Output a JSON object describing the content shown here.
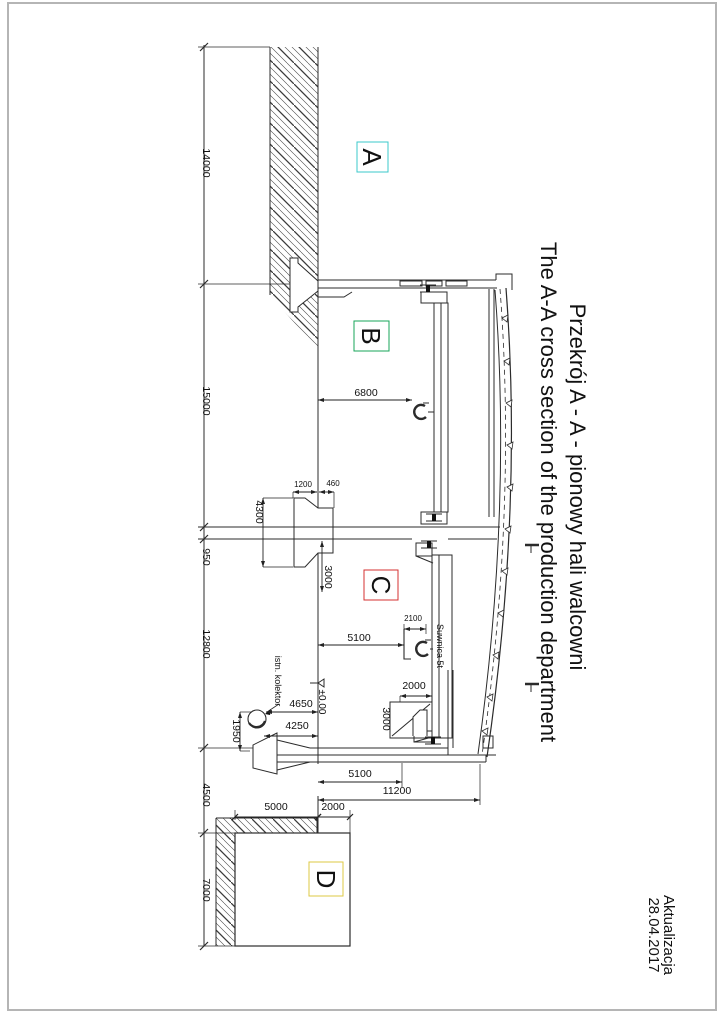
{
  "page": {
    "background": "#ffffff",
    "border_color": "#b5b5b5"
  },
  "title": {
    "polish": "Przekrój A - A - pionowy hali walcowni",
    "english": "The A-A cross section of the production department"
  },
  "revision": {
    "label": "Aktualizacja",
    "date": "28.04.2017"
  },
  "zones": [
    {
      "id": "A",
      "color": "#3bc8cb",
      "box": [
        357,
        142,
        31,
        30
      ],
      "text_pos": [
        363,
        157
      ]
    },
    {
      "id": "B",
      "color": "#17a55a",
      "box": [
        354,
        321,
        35,
        30
      ],
      "text_pos": [
        362,
        336
      ]
    },
    {
      "id": "C",
      "color": "#d43131",
      "box": [
        364,
        570,
        34,
        30
      ],
      "text_pos": [
        372,
        585
      ]
    },
    {
      "id": "D",
      "color": "#ddc843",
      "box": [
        309,
        862,
        34,
        34
      ],
      "text_pos": [
        317,
        879
      ]
    }
  ],
  "labels": [
    {
      "name": "crane-label",
      "text": "Suwnica 5t",
      "pos": [
        437,
        646
      ],
      "rot": true,
      "size": 9
    },
    {
      "name": "collector-label",
      "text": "istn. kolektor",
      "pos": [
        275,
        681
      ],
      "rot": true,
      "size": 9
    },
    {
      "name": "level-label",
      "text": "±0.00",
      "pos": [
        319,
        702
      ],
      "rot": true,
      "size": 10
    }
  ],
  "dimensions": [
    {
      "value": "14000",
      "text_pos": [
        203,
        163
      ],
      "rot": true
    },
    {
      "value": "15000",
      "text_pos": [
        203,
        401
      ],
      "rot": true
    },
    {
      "value": "950",
      "text_pos": [
        203,
        557
      ],
      "rot": true
    },
    {
      "value": "12800",
      "text_pos": [
        203,
        644
      ],
      "rot": true
    },
    {
      "value": "4500",
      "text_pos": [
        203,
        795
      ],
      "rot": true
    },
    {
      "value": "7000",
      "text_pos": [
        203,
        890
      ],
      "rot": true
    },
    {
      "value": "6800",
      "text_pos": [
        366,
        396
      ],
      "line": [
        318,
        400,
        412,
        400
      ],
      "style": "arrow"
    },
    {
      "value": "1200",
      "text_pos": [
        303,
        487
      ],
      "size": 8,
      "line": [
        293,
        492,
        317,
        492
      ],
      "style": "arrow",
      "ext": [
        [
          293,
          492,
          293,
          498
        ]
      ]
    },
    {
      "value": "460",
      "text_pos": [
        333,
        486
      ],
      "size": 8,
      "line": [
        319,
        492,
        334,
        492
      ],
      "style": "arrow",
      "ext": [
        [
          334,
          492,
          334,
          508
        ]
      ]
    },
    {
      "value": "4300",
      "text_pos": [
        256,
        512
      ],
      "rot": true,
      "line": [
        263,
        498,
        263,
        567
      ],
      "style": "arrow",
      "ext": [
        [
          263,
          498,
          293,
          498
        ],
        [
          263,
          567,
          293,
          567
        ]
      ]
    },
    {
      "value": "3000",
      "text_pos": [
        325,
        577
      ],
      "rot": true,
      "line": [
        322,
        541,
        322,
        592
      ],
      "style": "arrow"
    },
    {
      "value": "2100",
      "text_pos": [
        413,
        621
      ],
      "size": 8,
      "line": [
        404,
        629,
        426,
        629
      ],
      "style": "arrow",
      "ext": [
        [
          404,
          624,
          404,
          634
        ],
        [
          426,
          624,
          426,
          634
        ]
      ]
    },
    {
      "value": "5100",
      "text_pos": [
        359,
        641
      ],
      "line": [
        318,
        645,
        404,
        645
      ],
      "style": "arrow"
    },
    {
      "value": "2000",
      "text_pos": [
        414,
        689
      ],
      "line": [
        400,
        696,
        432,
        696
      ],
      "style": "arrow",
      "ext": [
        [
          400,
          696,
          400,
          702
        ],
        [
          432,
          696,
          432,
          702
        ]
      ]
    },
    {
      "value": "3000",
      "text_pos": [
        383,
        719
      ],
      "rot": true
    },
    {
      "value": "4650",
      "text_pos": [
        301,
        707
      ],
      "line": [
        266,
        712,
        318,
        712
      ],
      "style": "arrow"
    },
    {
      "value": "4250",
      "text_pos": [
        297,
        729
      ],
      "line": [
        264,
        736,
        318,
        736
      ],
      "style": "arrow"
    },
    {
      "value": "1950",
      "text_pos": [
        233,
        731
      ],
      "rot": true,
      "line": [
        240,
        712,
        240,
        751
      ],
      "style": "arrow",
      "ext": [
        [
          240,
          712,
          252,
          712
        ],
        [
          240,
          751,
          250,
          751
        ]
      ]
    },
    {
      "value": "5100",
      "text_pos": [
        360,
        777
      ],
      "line": [
        318,
        782,
        402,
        782
      ],
      "style": "arrow",
      "ext": [
        [
          402,
          763,
          402,
          787
        ]
      ]
    },
    {
      "value": "11200",
      "text_pos": [
        397,
        794
      ],
      "line": [
        318,
        800,
        480,
        800
      ],
      "style": "arrow",
      "ext": [
        [
          480,
          764,
          480,
          805
        ]
      ]
    },
    {
      "value": "5000",
      "text_pos": [
        276,
        810
      ],
      "line": [
        235,
        817,
        318,
        817
      ],
      "style": "tick",
      "ext": [
        [
          235,
          810,
          235,
          820
        ]
      ]
    },
    {
      "value": "2000",
      "text_pos": [
        333,
        810
      ],
      "line": [
        318,
        817,
        350,
        817
      ],
      "style": "tick",
      "ext": [
        [
          350,
          810,
          350,
          833
        ]
      ]
    }
  ]
}
